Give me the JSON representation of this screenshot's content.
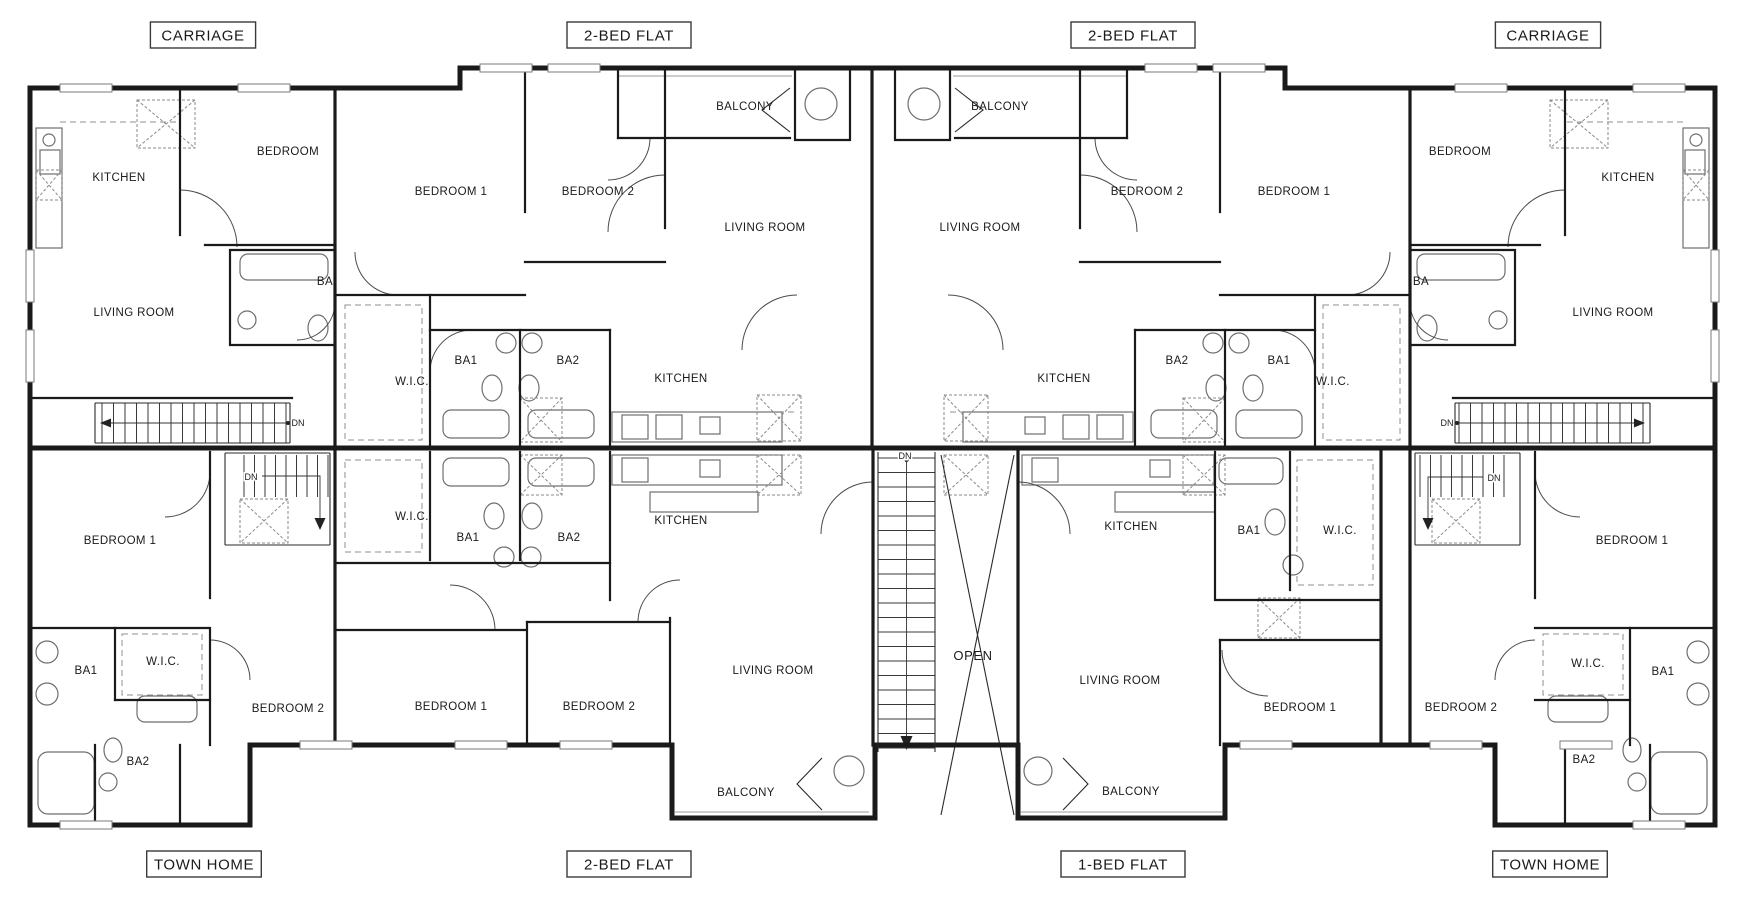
{
  "colors": {
    "background": "#ffffff",
    "wall": "#1a1a1a",
    "fixture": "#6e6e6e",
    "hatch": "#8a8a8a",
    "label": "#1a1a1a"
  },
  "floor_plan": {
    "units": [
      {
        "name": "CARRIAGE",
        "position": "top-left",
        "label_box": {
          "x": 203,
          "y": 35
        },
        "rooms": [
          {
            "label": "KITCHEN",
            "x": 119,
            "y": 181
          },
          {
            "label": "BEDROOM",
            "x": 288,
            "y": 155
          },
          {
            "label": "BA",
            "x": 325,
            "y": 285
          },
          {
            "label": "LIVING ROOM",
            "x": 134,
            "y": 316
          }
        ]
      },
      {
        "name": "2-BED FLAT",
        "position": "top-left-center",
        "label_box": {
          "x": 629,
          "y": 35
        },
        "rooms": [
          {
            "label": "BEDROOM 1",
            "x": 451,
            "y": 195
          },
          {
            "label": "BEDROOM 2",
            "x": 598,
            "y": 195
          },
          {
            "label": "BALCONY",
            "x": 745,
            "y": 110
          },
          {
            "label": "LIVING ROOM",
            "x": 765,
            "y": 231
          },
          {
            "label": "W.I.C.",
            "x": 412,
            "y": 385
          },
          {
            "label": "BA1",
            "x": 466,
            "y": 364
          },
          {
            "label": "BA2",
            "x": 568,
            "y": 364
          },
          {
            "label": "KITCHEN",
            "x": 681,
            "y": 382
          }
        ]
      },
      {
        "name": "2-BED FLAT",
        "position": "top-right-center",
        "label_box": {
          "x": 1133,
          "y": 35
        },
        "rooms": [
          {
            "label": "BALCONY",
            "x": 1000,
            "y": 110
          },
          {
            "label": "LIVING ROOM",
            "x": 980,
            "y": 231
          },
          {
            "label": "BEDROOM 2",
            "x": 1147,
            "y": 195
          },
          {
            "label": "BEDROOM 1",
            "x": 1294,
            "y": 195
          },
          {
            "label": "KITCHEN",
            "x": 1064,
            "y": 382
          },
          {
            "label": "BA2",
            "x": 1177,
            "y": 364
          },
          {
            "label": "BA1",
            "x": 1279,
            "y": 364
          },
          {
            "label": "W.I.C.",
            "x": 1333,
            "y": 385
          }
        ]
      },
      {
        "name": "CARRIAGE",
        "position": "top-right",
        "label_box": {
          "x": 1548,
          "y": 35
        },
        "rooms": [
          {
            "label": "BEDROOM",
            "x": 1460,
            "y": 155
          },
          {
            "label": "KITCHEN",
            "x": 1628,
            "y": 181
          },
          {
            "label": "BA",
            "x": 1421,
            "y": 285
          },
          {
            "label": "LIVING ROOM",
            "x": 1613,
            "y": 316
          }
        ]
      },
      {
        "name": "TOWN HOME",
        "position": "bottom-left",
        "label_box": {
          "x": 204,
          "y": 864
        },
        "rooms": [
          {
            "label": "BEDROOM 1",
            "x": 120,
            "y": 544
          },
          {
            "label": "BA1",
            "x": 86,
            "y": 674
          },
          {
            "label": "W.I.C.",
            "x": 163,
            "y": 665
          },
          {
            "label": "BEDROOM 2",
            "x": 288,
            "y": 712
          },
          {
            "label": "BA2",
            "x": 138,
            "y": 765
          }
        ]
      },
      {
        "name": "2-BED FLAT",
        "position": "bottom-left-center",
        "label_box": {
          "x": 629,
          "y": 864
        },
        "rooms": [
          {
            "label": "W.I.C.",
            "x": 412,
            "y": 520
          },
          {
            "label": "BA1",
            "x": 468,
            "y": 541
          },
          {
            "label": "BA2",
            "x": 569,
            "y": 541
          },
          {
            "label": "KITCHEN",
            "x": 681,
            "y": 524
          },
          {
            "label": "BEDROOM 1",
            "x": 451,
            "y": 710
          },
          {
            "label": "BEDROOM 2",
            "x": 599,
            "y": 710
          },
          {
            "label": "LIVING ROOM",
            "x": 773,
            "y": 674
          },
          {
            "label": "BALCONY",
            "x": 746,
            "y": 796
          }
        ]
      },
      {
        "name": "1-BED FLAT",
        "position": "bottom-right-center",
        "label_box": {
          "x": 1123,
          "y": 864
        },
        "rooms": [
          {
            "label": "KITCHEN",
            "x": 1131,
            "y": 530
          },
          {
            "label": "BA1",
            "x": 1249,
            "y": 534
          },
          {
            "label": "W.I.C.",
            "x": 1340,
            "y": 534
          },
          {
            "label": "LIVING ROOM",
            "x": 1120,
            "y": 684
          },
          {
            "label": "BEDROOM 1",
            "x": 1300,
            "y": 711
          },
          {
            "label": "BALCONY",
            "x": 1131,
            "y": 795
          }
        ]
      },
      {
        "name": "TOWN HOME",
        "position": "bottom-right",
        "label_box": {
          "x": 1550,
          "y": 864
        },
        "rooms": [
          {
            "label": "BEDROOM 1",
            "x": 1632,
            "y": 544
          },
          {
            "label": "W.I.C.",
            "x": 1588,
            "y": 667
          },
          {
            "label": "BA1",
            "x": 1663,
            "y": 675
          },
          {
            "label": "BEDROOM 2",
            "x": 1461,
            "y": 711
          },
          {
            "label": "BA2",
            "x": 1584,
            "y": 763
          }
        ]
      }
    ],
    "common_area": {
      "open_label": "OPEN"
    },
    "stair_notes": [
      {
        "label": "DN",
        "x": 298,
        "y": 426
      },
      {
        "label": "DN",
        "x": 1447,
        "y": 426
      },
      {
        "label": "DN",
        "x": 251,
        "y": 480
      },
      {
        "label": "DN",
        "x": 1494,
        "y": 481
      },
      {
        "label": "DN",
        "x": 905,
        "y": 459
      }
    ]
  }
}
